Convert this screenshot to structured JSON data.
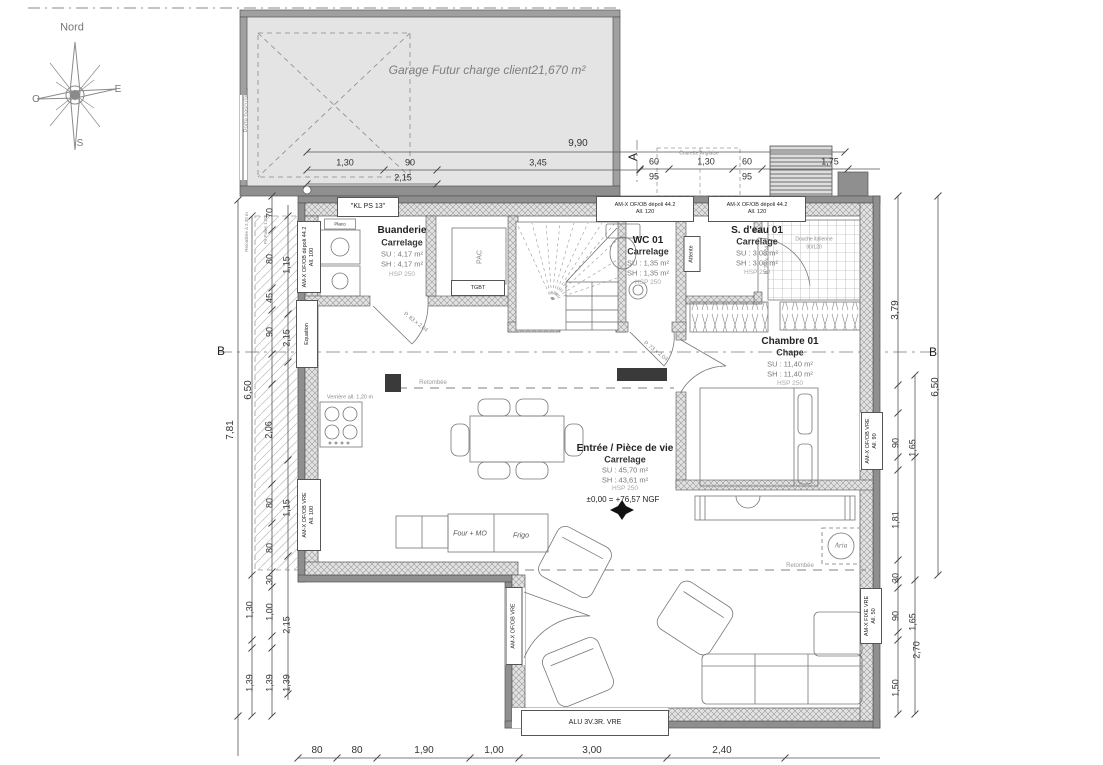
{
  "compass": {
    "n": "Nord",
    "o": "O",
    "e": "E",
    "s": "S"
  },
  "garage": {
    "label": "Garage Futur charge client21,670 m²",
    "door": "Porte basculante"
  },
  "rooms": {
    "buanderie": {
      "name": "Buanderie",
      "finish": "Carrelage",
      "su": "SU : 4,17 m²",
      "sh": "SH : 4,17 m²",
      "hsp": "HSP 250"
    },
    "wc": {
      "name": "WC 01",
      "finish": "Carrelage",
      "su": "SU : 1,35 m²",
      "sh": "SH : 1,35 m²",
      "hsp": "HSP 250"
    },
    "sdeau": {
      "name": "S. d'eau 01",
      "finish": "Carrelage",
      "su": "SU : 3,08 m²",
      "sh": "SH : 3,08 m²",
      "hsp": "HSP 250"
    },
    "chambre": {
      "name": "Chambre 01",
      "finish": "Chape",
      "su": "SU : 11,40 m²",
      "sh": "SH : 11,40 m²",
      "hsp": "HSP 250"
    },
    "vie": {
      "name": "Entrée / Pièce de vie",
      "finish": "Carrelage",
      "su": "SU : 45,70 m²",
      "sh": "SH : 43,61 m²",
      "hsp": "HSP 250",
      "ngf": "±0,00 = +76,57 NGF"
    }
  },
  "equip": {
    "pac": "PAC",
    "tgbt": "TGBT",
    "attente": "Attente",
    "four": "Four + MO",
    "frigo": "Frigo",
    "douche1": "Douche italienne",
    "douche2": "90/120",
    "verriere": "Verrière all. 1,20 m",
    "retombee": "Retombée",
    "kl": "\"KL PS 13\"",
    "courette": "Courette Anglaise",
    "equation": "Equation",
    "aria": "Aria",
    "placo": "Placo",
    "retombee230": "Retombée à 2,30 m",
    "palier": "Px Palier 1,20"
  },
  "openings": {
    "depoli": "AM-X OF/OB dépoli 44.2",
    "all120": "All. 120",
    "all100": "All. 100",
    "all90": "All. 90",
    "all50": "All. 50",
    "vre": "AM-X OF/OB VRE",
    "fixe": "AM-X FIXE VRE",
    "alu": "ALU 3V.3R. VRE",
    "p83": "P. 83 x 2,04",
    "p73": "P. 73 x 2,04"
  },
  "sections": {
    "a": "A",
    "b": "B"
  },
  "dims": {
    "garage": [
      "9,90",
      "1,30",
      "90",
      "3,45",
      "2,15"
    ],
    "top_right": [
      "60",
      "95",
      "1,30",
      "60",
      "95",
      "1,75"
    ],
    "left": [
      "70",
      "80",
      "1,15",
      "45",
      "90",
      "2,15",
      "2,06",
      "6,50",
      "7,81"
    ],
    "left_lower": [
      "80",
      "1,15",
      "80",
      "30",
      "1,00",
      "2,15",
      "1,30",
      "1,39",
      "1,39",
      "1,39"
    ],
    "right": [
      "3,79",
      "6,50",
      "90",
      "1,65",
      "1,81",
      "30",
      "90",
      "1,65",
      "2,70",
      "1,50"
    ],
    "bottom": [
      "80",
      "80",
      "1,90",
      "1,00",
      "3,00",
      "2,40"
    ]
  }
}
